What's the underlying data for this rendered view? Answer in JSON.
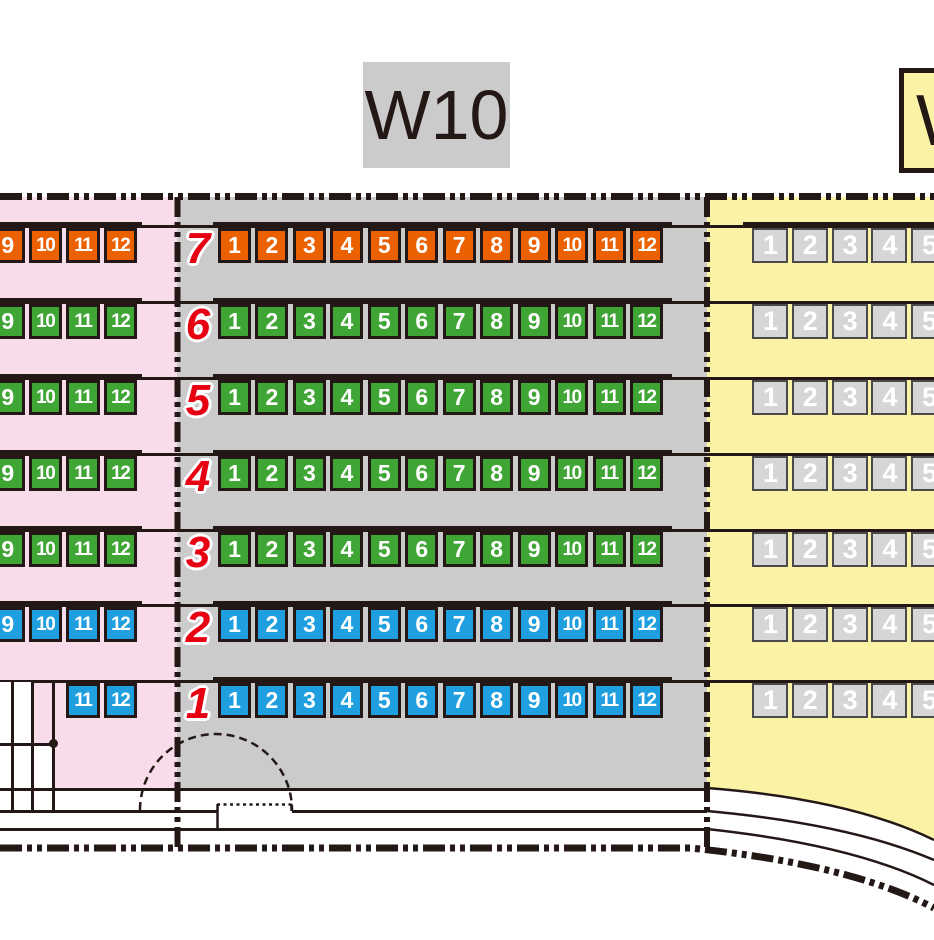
{
  "title_boxes": {
    "center": "W10",
    "right": "W"
  },
  "palette": {
    "orange": "#EB6100",
    "green": "#3FA535",
    "blue": "#1F9FDF",
    "right_seat_fill": "#D6D6D6",
    "right_seat_border": "#4A4A4A",
    "pink_bg": "#F9DCE9",
    "gray_bg": "#CBCBCB",
    "yellow_bg": "#FAF3A5",
    "title_gray_bg": "#CBCBCB",
    "line": "#231815",
    "row_label_red": "#E60012",
    "seat_text": "#FFFFFF"
  },
  "rows": [
    {
      "label": "7",
      "color": "orange",
      "left_seats": [
        "9",
        "10",
        "11",
        "12"
      ],
      "center_seats": [
        "1",
        "2",
        "3",
        "4",
        "5",
        "6",
        "7",
        "8",
        "9",
        "10",
        "11",
        "12"
      ],
      "right_seats": [
        "1",
        "2",
        "3",
        "4",
        "5"
      ]
    },
    {
      "label": "6",
      "color": "green",
      "left_seats": [
        "9",
        "10",
        "11",
        "12"
      ],
      "center_seats": [
        "1",
        "2",
        "3",
        "4",
        "5",
        "6",
        "7",
        "8",
        "9",
        "10",
        "11",
        "12"
      ],
      "right_seats": [
        "1",
        "2",
        "3",
        "4",
        "5"
      ]
    },
    {
      "label": "5",
      "color": "green",
      "left_seats": [
        "9",
        "10",
        "11",
        "12"
      ],
      "center_seats": [
        "1",
        "2",
        "3",
        "4",
        "5",
        "6",
        "7",
        "8",
        "9",
        "10",
        "11",
        "12"
      ],
      "right_seats": [
        "1",
        "2",
        "3",
        "4",
        "5"
      ]
    },
    {
      "label": "4",
      "color": "green",
      "left_seats": [
        "9",
        "10",
        "11",
        "12"
      ],
      "center_seats": [
        "1",
        "2",
        "3",
        "4",
        "5",
        "6",
        "7",
        "8",
        "9",
        "10",
        "11",
        "12"
      ],
      "right_seats": [
        "1",
        "2",
        "3",
        "4",
        "5"
      ]
    },
    {
      "label": "3",
      "color": "green",
      "left_seats": [
        "9",
        "10",
        "11",
        "12"
      ],
      "center_seats": [
        "1",
        "2",
        "3",
        "4",
        "5",
        "6",
        "7",
        "8",
        "9",
        "10",
        "11",
        "12"
      ],
      "right_seats": [
        "1",
        "2",
        "3",
        "4",
        "5"
      ]
    },
    {
      "label": "2",
      "color": "blue",
      "left_seats": [
        "9",
        "10",
        "11",
        "12"
      ],
      "center_seats": [
        "1",
        "2",
        "3",
        "4",
        "5",
        "6",
        "7",
        "8",
        "9",
        "10",
        "11",
        "12"
      ],
      "right_seats": [
        "1",
        "2",
        "3",
        "4",
        "5"
      ]
    },
    {
      "label": "1",
      "color": "blue",
      "left_seats": [
        "11",
        "12"
      ],
      "center_seats": [
        "1",
        "2",
        "3",
        "4",
        "5",
        "6",
        "7",
        "8",
        "9",
        "10",
        "11",
        "12"
      ],
      "right_seats": [
        "1",
        "2",
        "3",
        "4",
        "5"
      ]
    }
  ]
}
